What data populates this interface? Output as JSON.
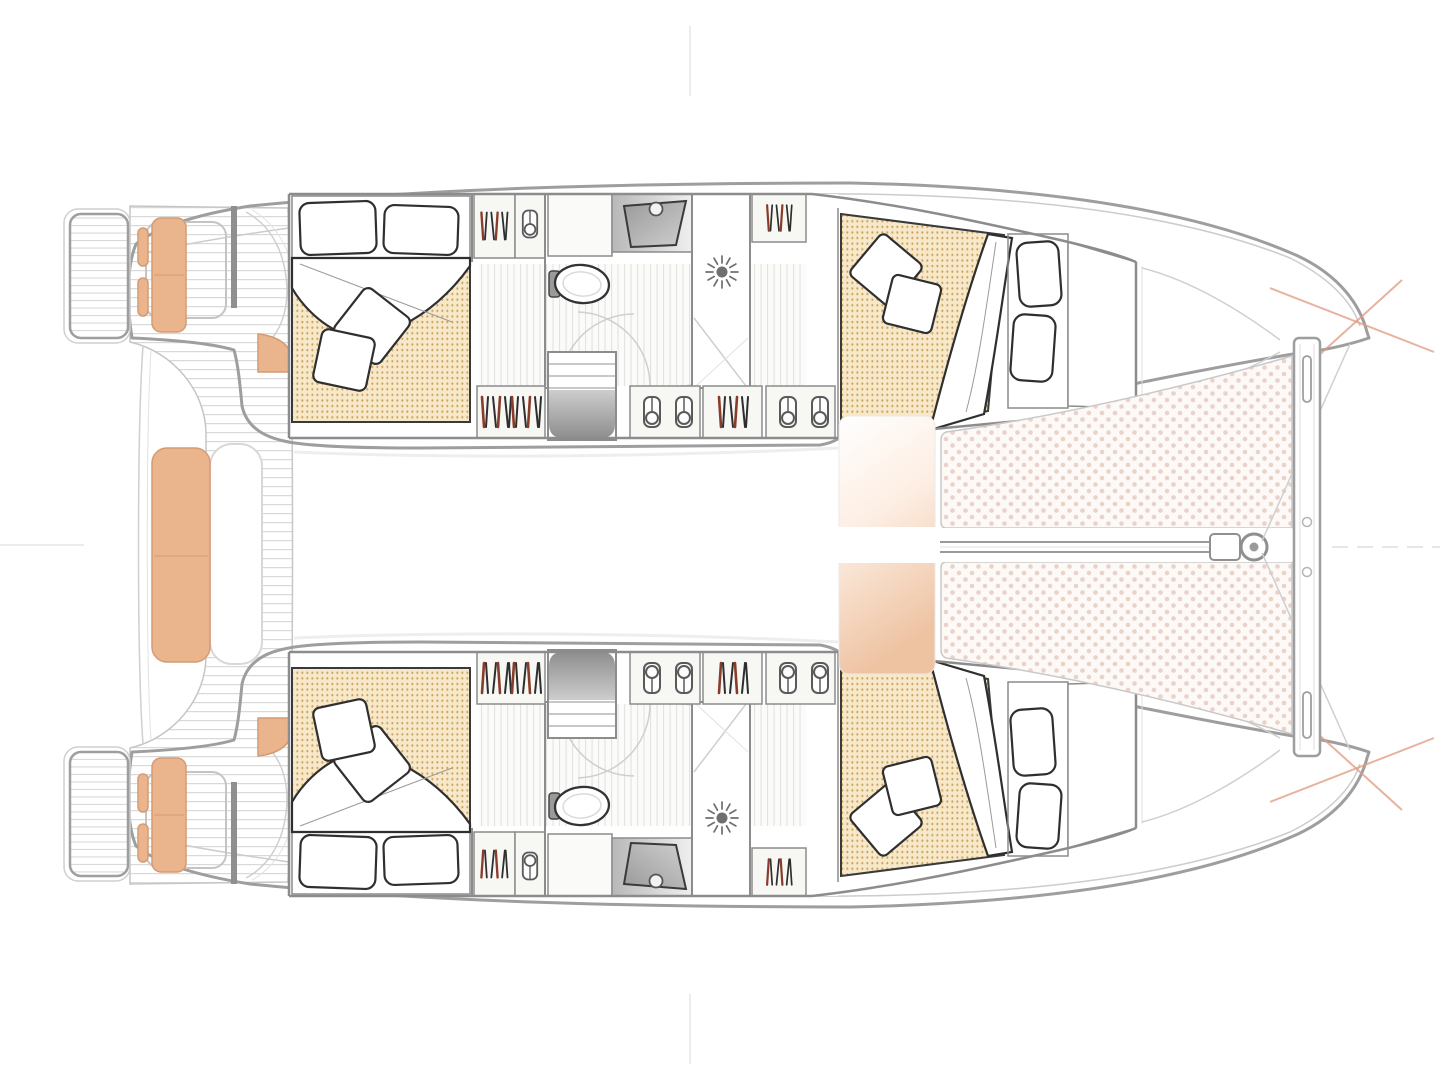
{
  "page": {
    "background": "#ffffff",
    "width": 1440,
    "height": 1080
  },
  "diagram": {
    "type": "boat-floor-plan",
    "view": "top-down-deck-plan",
    "vessel_type": "sailing-catamaran",
    "orientation": "bow-right-stern-left",
    "features": {
      "cabins": 4,
      "double_beds": 4,
      "bathrooms": 2,
      "showers": 2,
      "toilets": 2,
      "sinks": 2,
      "wardrobes_per_hull": 4,
      "companionway_stairs_per_hull": 1,
      "trampoline": true,
      "bowsprit": true,
      "aft_cockpit_benches": 3,
      "swim_platforms": 2
    },
    "zones": [
      {
        "id": "aft-cockpit",
        "label": "aft cockpit with teak deck and bench seating"
      },
      {
        "id": "port-hull",
        "label": "port hull: aft double cabin, bathroom, forward double cabin"
      },
      {
        "id": "starboard-hull",
        "label": "starboard hull: aft double cabin, bathroom, forward double cabin"
      },
      {
        "id": "bridgedeck",
        "label": "central bridgedeck"
      },
      {
        "id": "foredeck",
        "label": "bow trampoline, bowsprit and crossbeam"
      }
    ],
    "icons": [
      "clothes-rail-icon",
      "hook-icon",
      "shower-drain-icon",
      "toilet-icon",
      "sink-icon",
      "bow-marker-cross-icon"
    ],
    "colors": {
      "hull_outline": "#9e9e9e",
      "wall": "#8c8c8c",
      "furniture_stroke": "#2f2f2f",
      "cushion_tan": "#eab48d",
      "cushion_tan_edge": "#d49b74",
      "mattress_bg": "#f6e8c9",
      "mattress_dot": "#cda45f",
      "trampoline_bg": "#fdf9f6",
      "trampoline_dot": "#e8d2c9",
      "deck_plank": "#d9d9d9",
      "floor_plank": "#e3e3e0",
      "stair_light": "#cdcdcd",
      "stair_dark": "#8e8e8e",
      "peach_glow": "#eec3a2",
      "marker_red": "#e09a80",
      "metal_gray": "#6f6f6f",
      "hanger_red": "#8a3c2a",
      "hanger_dark": "#2e2e2e"
    }
  }
}
